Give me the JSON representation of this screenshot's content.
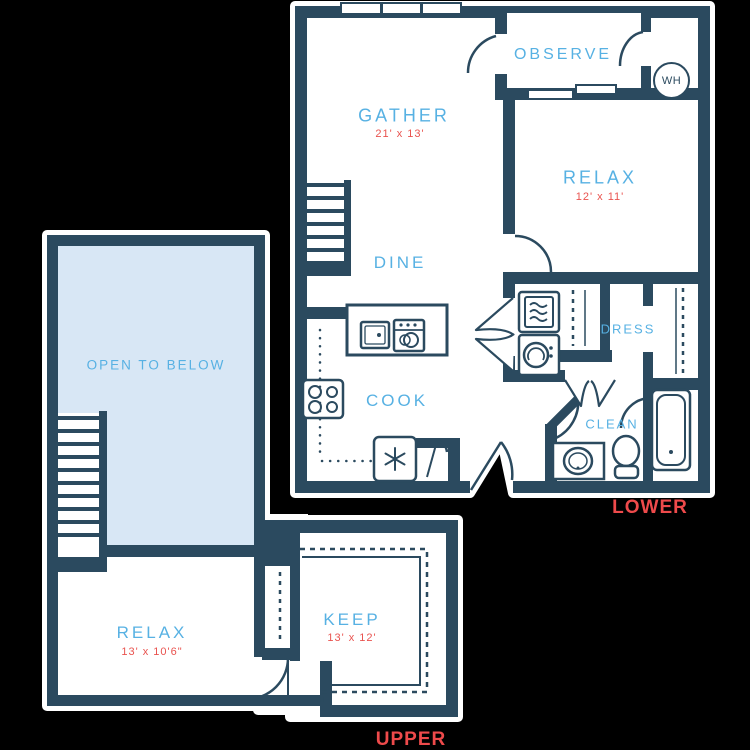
{
  "title": "Two-level floor plan",
  "colors": {
    "background": "#000000",
    "wall": "#2b4a5f",
    "room_label": "#57b1e3",
    "dimension_label": "#e9534f",
    "level_label": "#ee4a4b",
    "open_area_fill": "#d8e7f5",
    "floor_fill": "#ffffff"
  },
  "floors": {
    "lower": {
      "level_label": "LOWER",
      "rooms": {
        "observe": {
          "label": "OBSERVE"
        },
        "gather": {
          "label": "GATHER",
          "dims": "21' x 13'"
        },
        "relax": {
          "label": "RELAX",
          "dims": "12' x 11'"
        },
        "dine": {
          "label": "DINE"
        },
        "cook": {
          "label": "COOK"
        },
        "dress": {
          "label": "DRESS"
        },
        "clean": {
          "label": "CLEAN"
        }
      },
      "water_heater": {
        "label": "WH"
      }
    },
    "upper": {
      "level_label": "UPPER",
      "rooms": {
        "open_to_below": {
          "label": "OPEN TO BELOW"
        },
        "relax": {
          "label": "RELAX",
          "dims": "13' x 10'6\""
        },
        "keep": {
          "label": "KEEP",
          "dims": "13' x 12'"
        }
      }
    }
  },
  "icons": [
    "stairs-icon",
    "window-icon",
    "door-swing-icon",
    "bifold-door-icon",
    "closet-rod-icon",
    "kitchen-island-icon",
    "sink-icon",
    "dishwasher-icon",
    "stove-icon",
    "refrigerator-icon",
    "snowflake-icon",
    "dryer-icon",
    "washer-icon",
    "bathtub-icon",
    "vanity-sink-icon",
    "toilet-icon",
    "water-heater-icon"
  ]
}
